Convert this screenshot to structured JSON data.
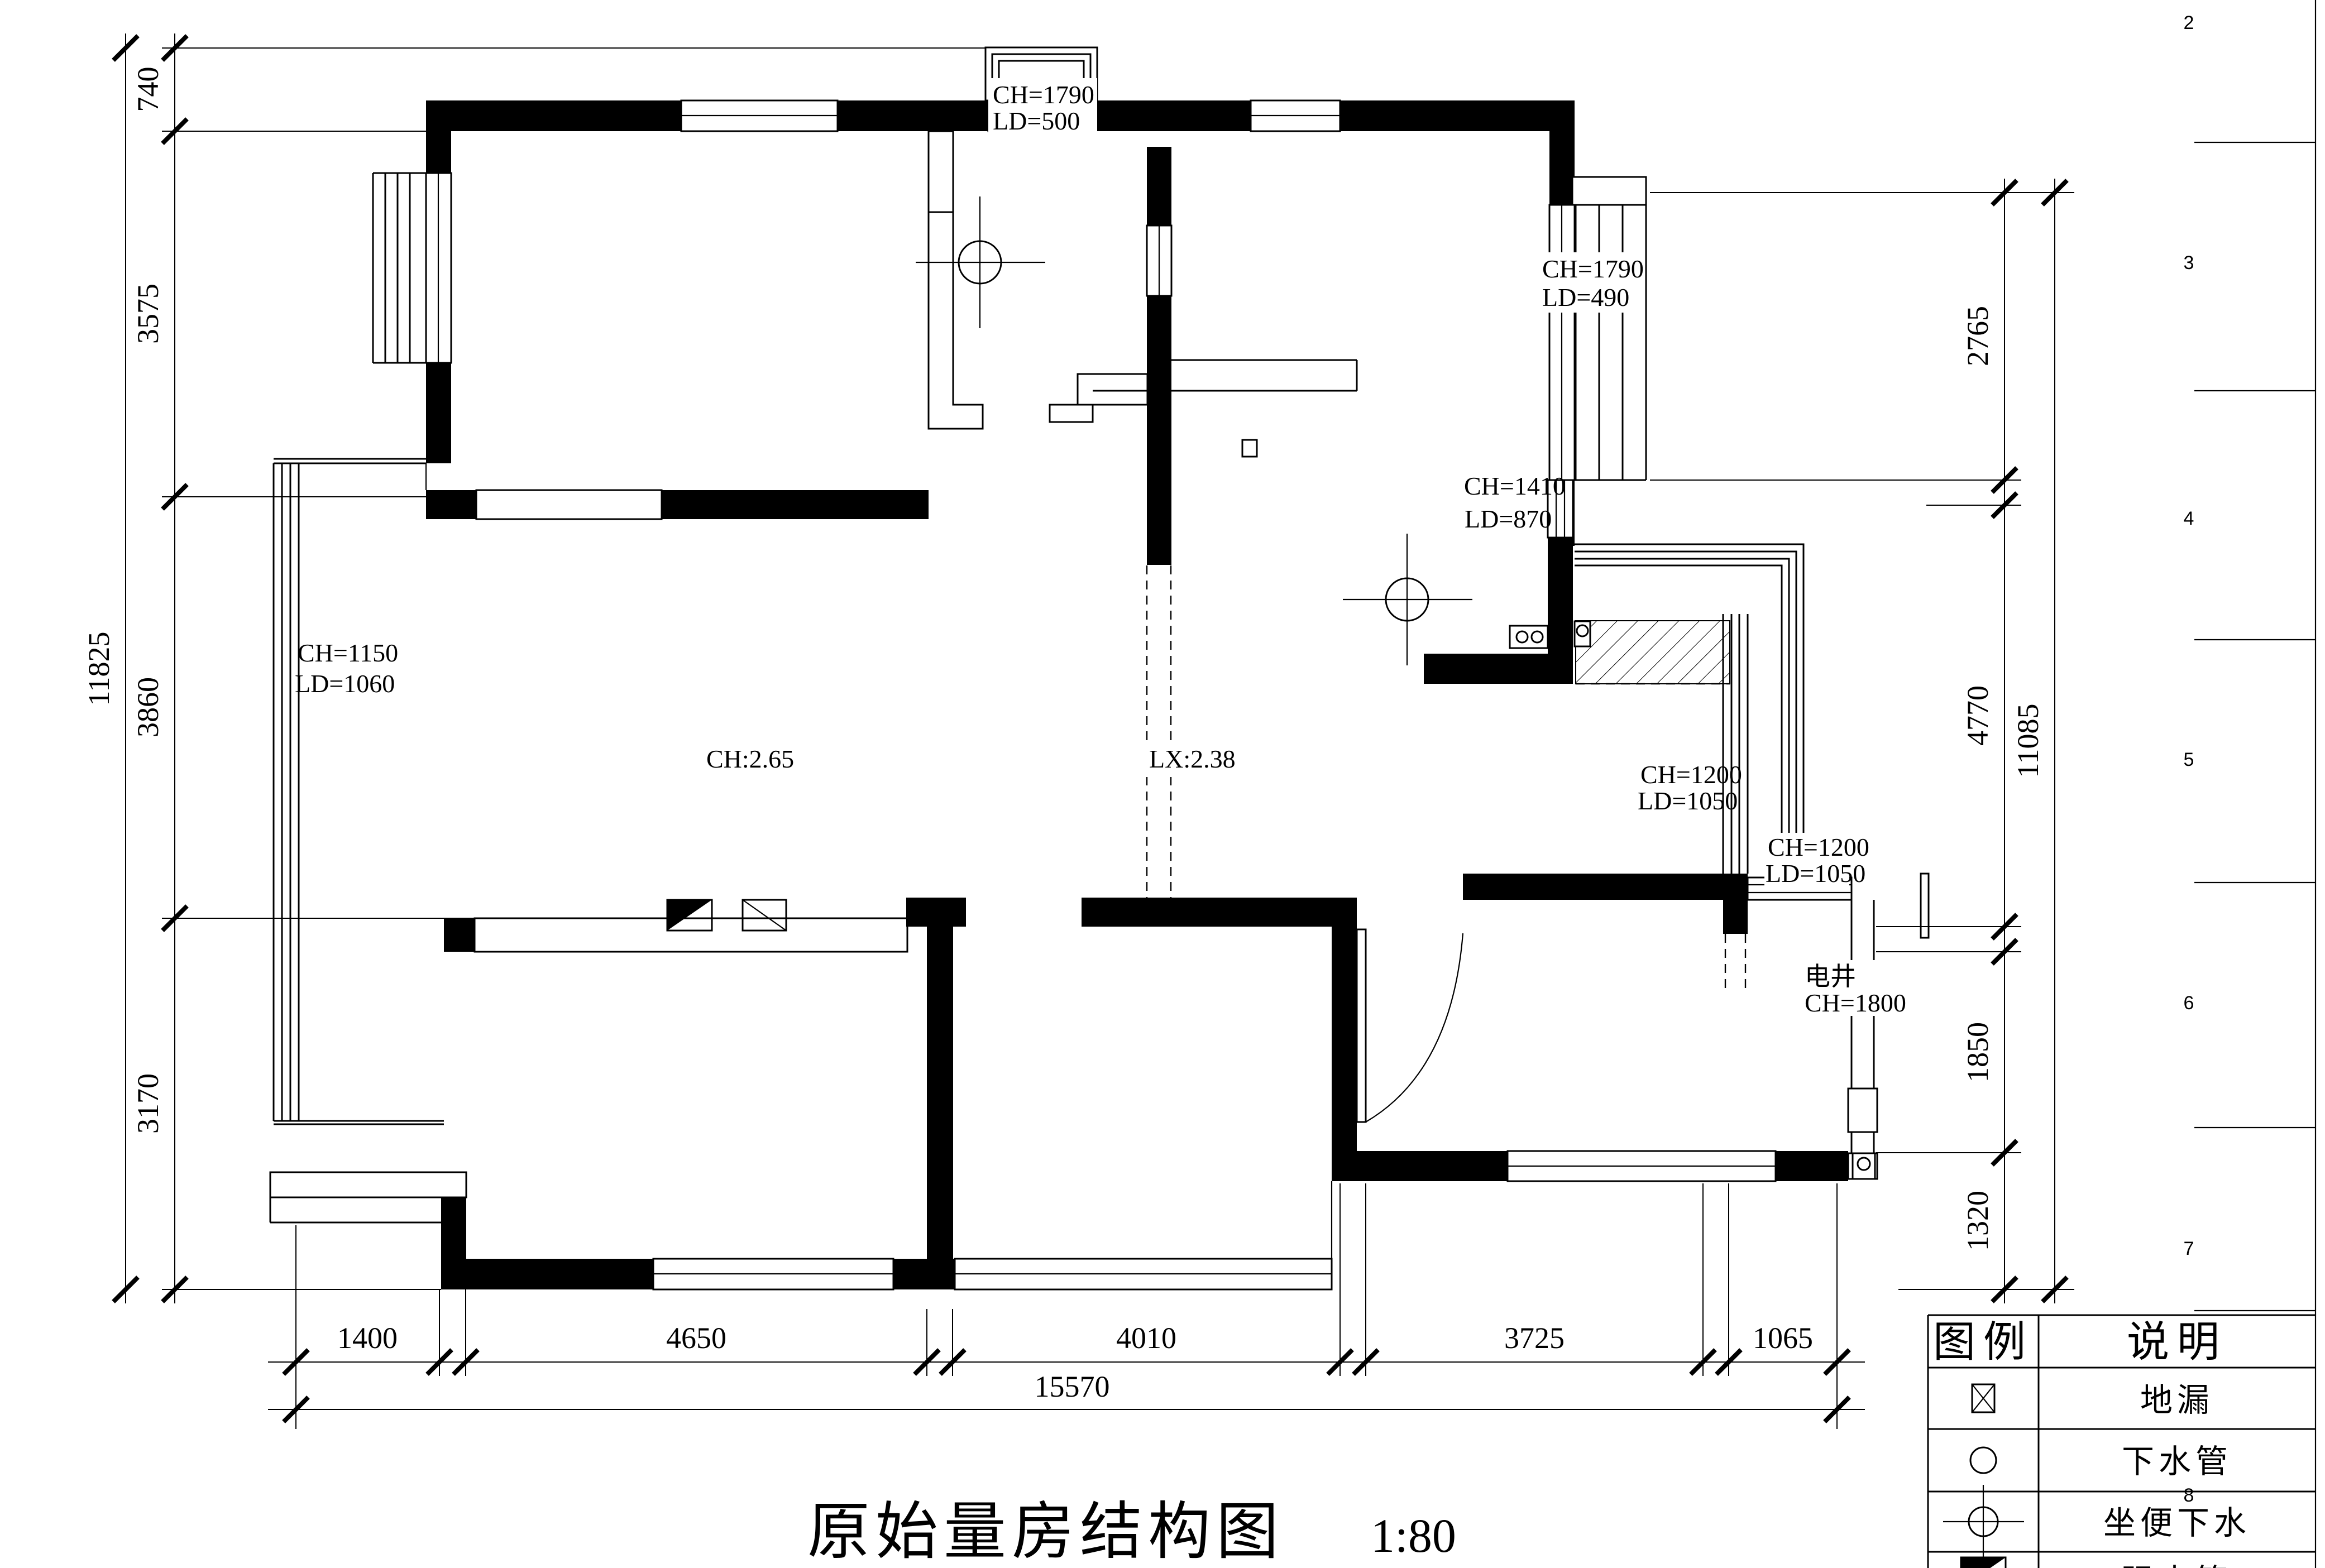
{
  "title": {
    "name": "原始量房结构图",
    "scale": "1:80"
  },
  "dims": {
    "left": {
      "segments": [
        "740",
        "3575",
        "3860",
        "3170"
      ],
      "total": "11825"
    },
    "right": {
      "segments": [
        "2765",
        "4770",
        "1850",
        "1320"
      ],
      "total": "11085"
    },
    "bottom": {
      "segments": [
        "1400",
        "4650",
        "4010",
        "3725",
        "1065"
      ],
      "total": "15570"
    }
  },
  "annotations": {
    "win_top_center": {
      "ch": "CH=1790",
      "ld": "LD=500"
    },
    "win_top_right": {
      "ch": "CH=1790",
      "ld": "LD=490"
    },
    "win_kitchen": {
      "ch": "CH=1410",
      "ld": "LD=870"
    },
    "win_left": {
      "ch": "CH=1150",
      "ld": "LD=1060"
    },
    "ceiling_height": "CH:2.65",
    "beam_height": "LX:2.38",
    "win_balcony": {
      "ch": "CH=1200",
      "ld": "LD=1050"
    },
    "win_bedroom2": {
      "ch": "CH=1200",
      "ld": "LD=1050"
    },
    "shaft": {
      "name": "电井",
      "ch": "CH=1800"
    }
  },
  "sheet": {
    "row_numbers": [
      "2",
      "3",
      "4",
      "5",
      "6",
      "7",
      "8"
    ]
  },
  "legend": {
    "headers": [
      "图例",
      "说明"
    ],
    "rows": [
      {
        "symbol": "floor-drain-icon",
        "label": "地漏"
      },
      {
        "symbol": "drain-pipe-icon",
        "label": "下水管"
      },
      {
        "symbol": "toilet-drain-icon",
        "label": "坐便下水"
      },
      {
        "symbol": "power-box-icon",
        "label": "强电箱"
      }
    ]
  }
}
